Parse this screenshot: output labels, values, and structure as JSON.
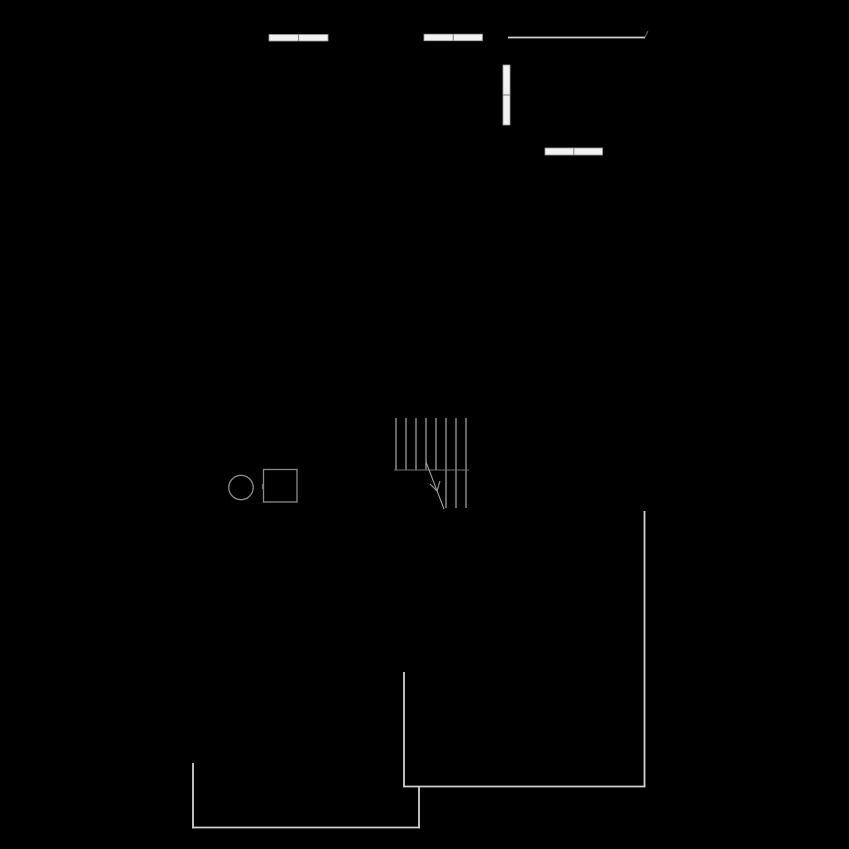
{
  "canvas": {
    "width": 849,
    "height": 849,
    "background": "#000000"
  },
  "palette": {
    "wall": "#d2d2d2",
    "faint": "#6f6f6f",
    "stair": "#9c9c9c",
    "fixture": "#8a8a8a",
    "window_fill": "#f2f2f2",
    "window_stroke": "#9b9b9b",
    "window_divider": "#8d8d8d"
  },
  "windows": [
    {
      "id": "window-top-left",
      "x": 269,
      "y": 34.5,
      "w": 59,
      "h": 6.5,
      "orientation": "horizontal"
    },
    {
      "id": "window-top-middle",
      "x": 424,
      "y": 34.2,
      "w": 58.5,
      "h": 6.5,
      "orientation": "horizontal"
    },
    {
      "id": "window-right-vertical",
      "x": 503,
      "y": 65,
      "w": 7,
      "h": 60,
      "orientation": "vertical"
    },
    {
      "id": "window-mid-right",
      "x": 545,
      "y": 148,
      "w": 57.5,
      "h": 7,
      "orientation": "horizontal"
    }
  ],
  "walls": [
    {
      "x1": 508,
      "y1": 37.5,
      "x2": 645,
      "y2": 37.5,
      "tone": "wall",
      "width": 1.8
    },
    {
      "x1": 645,
      "y1": 37,
      "x2": 648,
      "y2": 31,
      "tone": "faint",
      "width": 1
    },
    {
      "x1": 644.5,
      "y1": 511,
      "x2": 644.5,
      "y2": 787.4,
      "tone": "wall",
      "width": 1.8
    },
    {
      "x1": 404,
      "y1": 786.5,
      "x2": 645.4,
      "y2": 786.5,
      "tone": "wall",
      "width": 1.8
    },
    {
      "x1": 404,
      "y1": 672,
      "x2": 404,
      "y2": 787.4,
      "tone": "wall",
      "width": 1.8
    },
    {
      "x1": 193,
      "y1": 763,
      "x2": 193,
      "y2": 828.4,
      "tone": "wall",
      "width": 1.8
    },
    {
      "x1": 192.2,
      "y1": 827.5,
      "x2": 419.8,
      "y2": 827.5,
      "tone": "wall",
      "width": 1.8
    },
    {
      "x1": 419,
      "y1": 786.5,
      "x2": 419,
      "y2": 828.4,
      "tone": "wall",
      "width": 1.8
    }
  ],
  "stairs": {
    "treads": [
      {
        "x": 396,
        "y1": 418,
        "y2": 470
      },
      {
        "x": 406,
        "y1": 418,
        "y2": 470
      },
      {
        "x": 416,
        "y1": 418,
        "y2": 470
      },
      {
        "x": 426,
        "y1": 418,
        "y2": 470
      },
      {
        "x": 436,
        "y1": 418,
        "y2": 470
      },
      {
        "x": 446,
        "y1": 418,
        "y2": 470
      },
      {
        "x": 456,
        "y1": 418,
        "y2": 470
      },
      {
        "x": 466,
        "y1": 418,
        "y2": 470
      },
      {
        "x": 446,
        "y1": 470,
        "y2": 508
      },
      {
        "x": 456,
        "y1": 470,
        "y2": 508
      },
      {
        "x": 466,
        "y1": 470,
        "y2": 508
      }
    ],
    "break_line": {
      "x1": 394,
      "y1": 470,
      "x2": 469,
      "y2": 470
    },
    "arrow": {
      "line": {
        "x1": 426,
        "y1": 462,
        "x2": 444,
        "y2": 509
      },
      "head": [
        {
          "x1": 437,
          "y1": 491,
          "x2": 430,
          "y2": 484
        },
        {
          "x1": 437,
          "y1": 491,
          "x2": 440,
          "y2": 481
        }
      ]
    }
  },
  "fixtures": {
    "circle": {
      "cx": 241,
      "cy": 487.5,
      "r": 12.2
    },
    "square": {
      "x": 263.5,
      "y": 469.5,
      "w": 33.5,
      "h": 32.5
    },
    "tick": {
      "x1": 262.5,
      "y1": 484,
      "x2": 262.5,
      "y2": 489
    }
  }
}
